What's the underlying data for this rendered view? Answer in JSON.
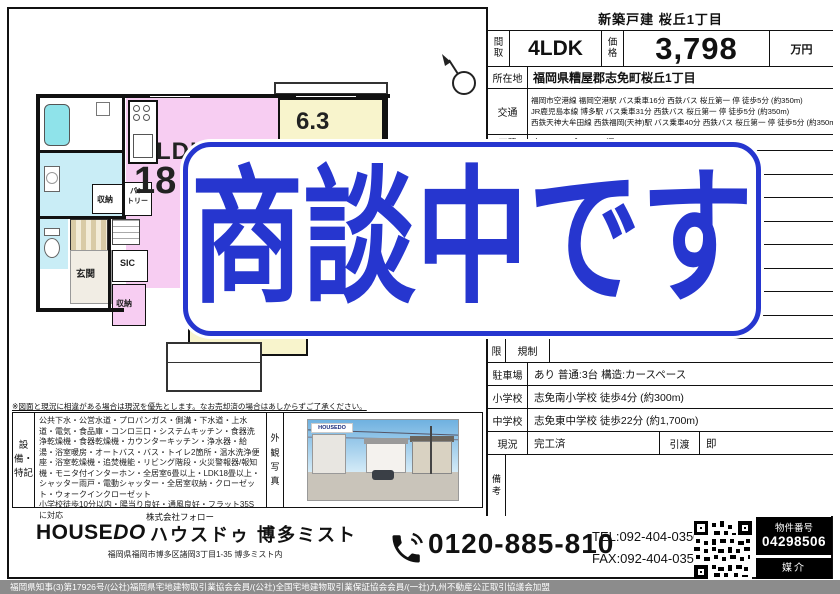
{
  "banner": {
    "text": "商談中です",
    "color": "#2636cf"
  },
  "listing": {
    "header_title": "新築戸建 桜丘1丁目",
    "floor_label": "間取",
    "floor": "4LDK",
    "price_label": "価格",
    "price": "3,798",
    "price_unit": "万円",
    "address_label": "所在地",
    "address": "福岡県糟屋郡志免町桜丘1丁目",
    "access_label": "交通",
    "access_lines": [
      "福岡市空港線 福岡空港駅 バス乗車16分 西鉄バス 桜丘第一 停 徒歩5分 (約350m)",
      "JR鹿児島本線 博多駅  バス乗車31分 西鉄バス 桜丘第一 停 徒歩5分 (約350m)",
      "西鉄天神大牟田線 西鉄福岡(天神)駅 バス乗車40分 西鉄バス 桜丘第一 停 徒歩5分 (約350m)"
    ],
    "area_label": "面積",
    "area_value": "宅105.19㎡ (50.94坪)",
    "restriction_outer_label": "限",
    "restriction_label": "規制",
    "restriction_value": "",
    "parking_label": "駐車場",
    "parking_value": "あり 普通:3台 構造:カースペース",
    "elementary_label": "小学校",
    "elementary_value": "志免南小学校 徒歩4分 (約300m)",
    "junior_label": "中学校",
    "junior_value": "志免東中学校 徒歩22分 (約1,700m)",
    "status_label": "現況",
    "status_value": "完工済",
    "handover_label": "引渡",
    "handover_value": "即",
    "remarks_label": "備考",
    "remarks_value": ""
  },
  "floor_plan": {
    "ldk_label": "LDK",
    "ldk_size": "18",
    "room_upper": "6.3",
    "room_lower": "6",
    "entrance_label": "玄関",
    "sic_label": "SIC",
    "closet1_label": "収納",
    "closet2_label": "収納",
    "pantry_line1": "パン",
    "pantry_line2": "トリー"
  },
  "notes": {
    "disclaimer": "※図面と現況に相違がある場合は現況を優先とします。なお売却済の場合はあしからずご了承ください。",
    "equipment_label": "設備・特記",
    "features": "公共下水・公営水道・プロパンガス・側溝・下水道・上水道・電気・食品庫・コンロ三口・システムキッチン・食器洗浄乾燥機・食器乾燥機・カウンターキッチン・浄水器・給湯・浴室暖房・オートバス・バス・トイレ2箇所・温水洗浄便座・浴室乾燥機・追焚機能・リビング階段・火災警報器/報知機・モニタ付インターホン・全居室6畳以上・LDK18畳以上・シャッター雨戸・電動シャッター・全居室収納・クローゼット・ウォークインクローゼット",
    "extra": "小学校徒歩10分以内・陽当り良好・通風良好・フラット35Sに対応",
    "photo_label": "外観写真",
    "photo_watermark": "HOUSEDO"
  },
  "footer": {
    "company": "株式会社フォロー",
    "logo_house": "HOUSE",
    "logo_do": "DO",
    "shop_name": "ハウスドゥ 博多ミスト",
    "shop_address": "福岡県福岡市博多区諸岡3丁目1-35  博多ミスト内",
    "freedial": "0120-885-810",
    "tel": "TEL:092-404-0350",
    "fax": "FAX:092-404-0351",
    "property_no_label": "物件番号",
    "property_no": "04298506",
    "transaction_type": "媒介",
    "license": "福岡県知事(3)第17926号/(公社)福岡県宅地建物取引業協会会員/(公社)全国宅地建物取引業保証協会会員/(一社)九州不動産公正取引協議会加盟"
  },
  "colors": {
    "banner_blue": "#2636cf",
    "ldk_pink": "#f7cdf2",
    "room_yellow": "#f8f4cc",
    "wet_blue": "#c9edf6",
    "tub_cyan": "#8fe3ea"
  }
}
